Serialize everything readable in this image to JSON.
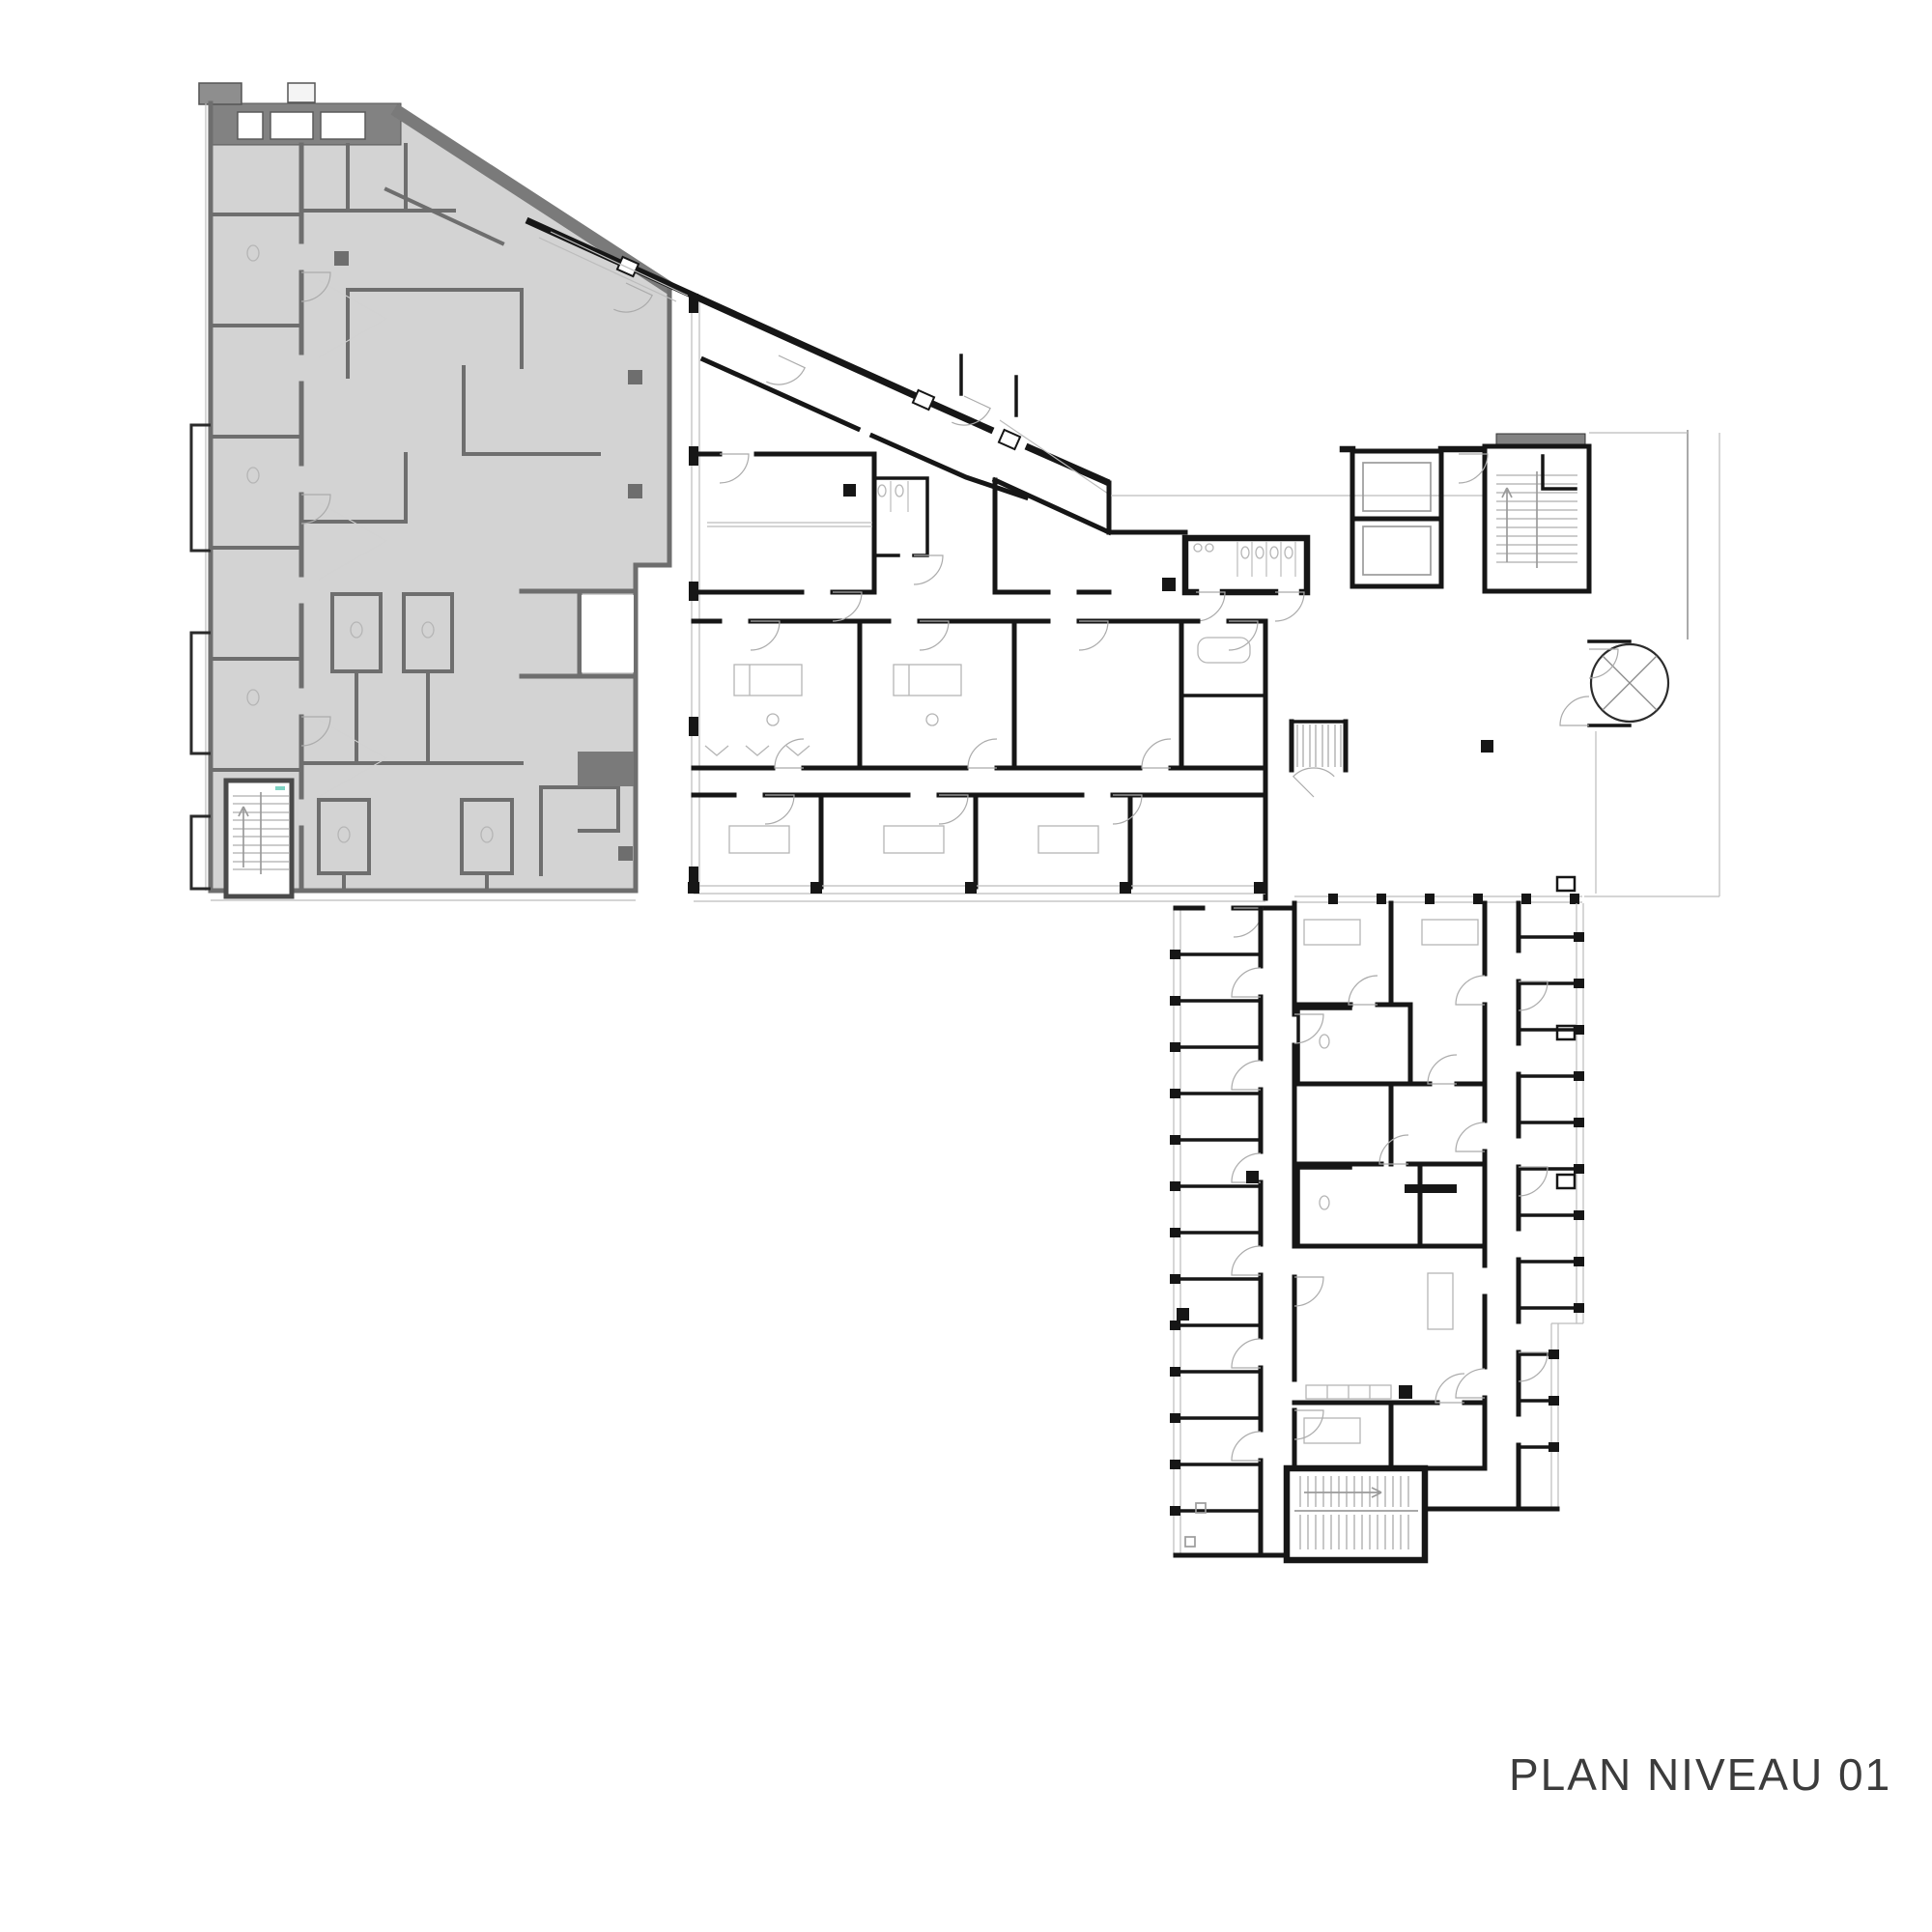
{
  "title": {
    "text": "PLAN NIVEAU 01"
  },
  "colors": {
    "background": "#ffffff",
    "highlighted_zone_fill": "#d3d3d3",
    "highlighted_zone_wall": "#6e6e6e",
    "roof_band_fill": "#828282",
    "black_wall": "#161616",
    "thin_line": "#bcbcbc",
    "title_text": "#3c3c3c"
  },
  "plan": {
    "level_label": "PLAN NIVEAU 01",
    "features": [
      "highlighted-west-block",
      "stair-northwest",
      "stair-northeast",
      "stair-junction",
      "stair-south",
      "elevator-bank",
      "revolving-door",
      "toilet-block",
      "entrance-ramp",
      "lower-wing",
      "middle-wing",
      "lobby"
    ]
  }
}
